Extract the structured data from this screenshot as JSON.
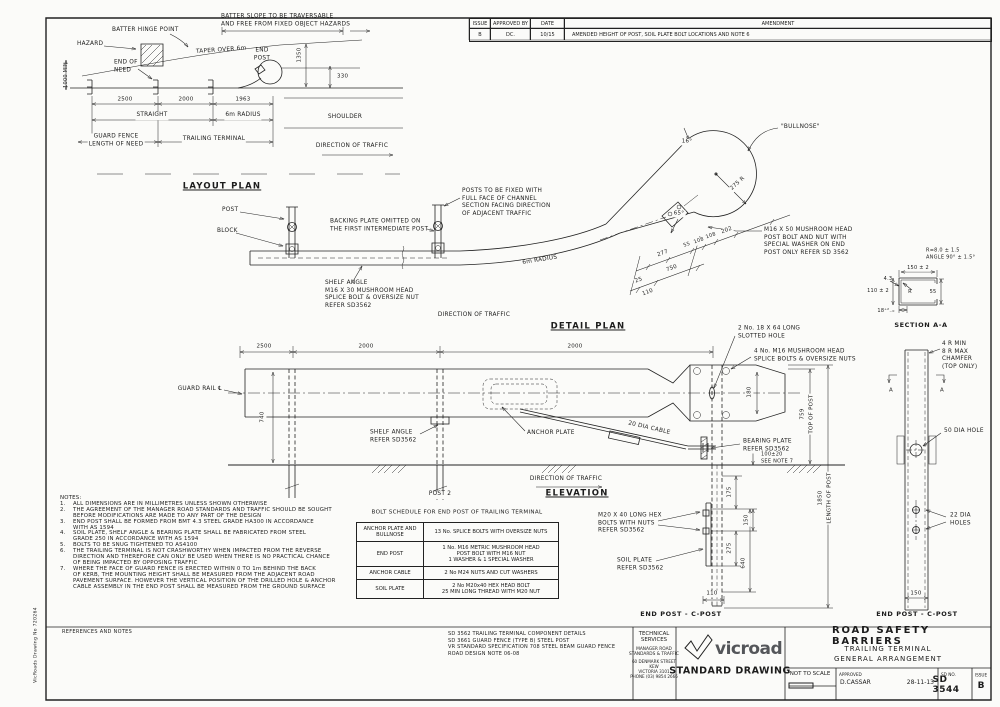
{
  "side_label": "VicRoads Drawing No 720264",
  "issue_table": {
    "headers": [
      "ISSUE",
      "APPROVED BY",
      "DATE",
      "AMENDMENT"
    ],
    "rows": [
      {
        "issue": "B",
        "approved_by": "DC.",
        "date": "10/15",
        "amendment": "AMENDED HEIGHT OF POST, SOIL PLATE BOLT LOCATIONS AND NOTE 6"
      }
    ]
  },
  "layout_plan": {
    "annotations": [
      {
        "t": "BATTER SLOPE TO BE TRAVERSABLE\nAND FREE FROM FIXED OBJECT HAZARDS",
        "x": 221,
        "y": 21,
        "a": "l"
      },
      {
        "t": "BATTER HINGE POINT",
        "x": 112,
        "y": 31,
        "a": "l"
      },
      {
        "t": "HAZARD",
        "x": 77,
        "y": 45,
        "a": "l"
      },
      {
        "t": "TAPER OVER 6m",
        "x": 196,
        "y": 51,
        "a": "l",
        "r": -4
      },
      {
        "t": "END\nPOST",
        "x": 262,
        "y": 55
      },
      {
        "t": "END OF\nNEED",
        "x": 114,
        "y": 67,
        "a": "l"
      },
      {
        "t": "1000 MIN",
        "x": 66,
        "y": 75,
        "r": -90,
        "fs": 5
      },
      {
        "t": "1350",
        "x": 300,
        "y": 55,
        "r": -90,
        "fs": 5.5,
        "cls": "wbg"
      },
      {
        "t": "330",
        "x": 337,
        "y": 77,
        "a": "l",
        "fs": 5.5
      },
      {
        "t": "2500",
        "x": 125,
        "y": 100,
        "fs": 5.5,
        "cls": "wbg"
      },
      {
        "t": "2000",
        "x": 186,
        "y": 100,
        "fs": 5.5,
        "cls": "wbg"
      },
      {
        "t": "1963",
        "x": 243,
        "y": 100,
        "fs": 5.5,
        "cls": "wbg"
      },
      {
        "t": "STRAIGHT",
        "x": 152,
        "y": 116,
        "cls": "wbg"
      },
      {
        "t": "6m RADIUS",
        "x": 243,
        "y": 116,
        "cls": "wbg"
      },
      {
        "t": "SHOULDER",
        "x": 345,
        "y": 118
      },
      {
        "t": "GUARD FENCE\nLENGTH OF NEED",
        "x": 116,
        "y": 141,
        "cls": "wbg"
      },
      {
        "t": "TRAILING TERMINAL",
        "x": 214,
        "y": 140,
        "cls": "wbg"
      },
      {
        "t": "DIRECTION OF TRAFFIC",
        "x": 352,
        "y": 147
      },
      {
        "t": "LAYOUT PLAN",
        "x": 222,
        "y": 187,
        "cls": "title"
      }
    ]
  },
  "detail_plan": {
    "annotations": [
      {
        "t": "POST",
        "x": 222,
        "y": 211,
        "a": "l"
      },
      {
        "t": "BLOCK",
        "x": 217,
        "y": 232,
        "a": "l"
      },
      {
        "t": "BACKING PLATE OMITTED ON\nTHE FIRST INTERMEDIATE POST",
        "x": 330,
        "y": 226,
        "a": "l"
      },
      {
        "t": "POSTS TO BE FIXED WITH\nFULL FACE OF CHANNEL\nSECTION FACING DIRECTION\nOF ADJACENT TRAFFIC",
        "x": 462,
        "y": 203,
        "a": "l"
      },
      {
        "t": "SHELF ANGLE\nM16 X 30 MUSHROOM HEAD\nSPLICE BOLT & OVERSIZE NUT\nREFER SD3562",
        "x": 325,
        "y": 295,
        "a": "l"
      },
      {
        "t": "6m RADIUS",
        "x": 540,
        "y": 261,
        "r": -9,
        "cls": "wbg"
      },
      {
        "t": "DIRECTION OF TRAFFIC",
        "x": 474,
        "y": 316
      },
      {
        "t": "DETAIL PLAN",
        "x": 588,
        "y": 327,
        "cls": "title"
      }
    ]
  },
  "bullnose": {
    "annotations": [
      {
        "t": "\"BULLNOSE\"",
        "x": 781,
        "y": 128,
        "a": "l"
      },
      {
        "t": "16°",
        "x": 687,
        "y": 142,
        "fs": 5.5,
        "cls": "wbg"
      },
      {
        "t": "65°",
        "x": 679,
        "y": 214,
        "fs": 5.5,
        "cls": "wbg"
      },
      {
        "t": "275 R",
        "x": 738,
        "y": 184,
        "r": -42,
        "fs": 5.5,
        "cls": "wbg"
      },
      {
        "t": "M16 X 50 MUSHROOM HEAD\nPOST BOLT AND NUT WITH\nSPECIAL WASHER ON END\nPOST ONLY REFER SD 3562",
        "x": 764,
        "y": 242,
        "a": "l"
      },
      {
        "t": "277",
        "x": 663,
        "y": 254,
        "r": -20,
        "fs": 5.5,
        "cls": "wbg"
      },
      {
        "t": "55",
        "x": 687,
        "y": 245,
        "r": -20,
        "fs": 5,
        "cls": "wbg"
      },
      {
        "t": "108",
        "x": 699,
        "y": 241,
        "r": -20,
        "fs": 5,
        "cls": "wbg"
      },
      {
        "t": "108",
        "x": 711,
        "y": 236,
        "r": -20,
        "fs": 5,
        "cls": "wbg"
      },
      {
        "t": "202",
        "x": 727,
        "y": 231,
        "r": -20,
        "fs": 5.5,
        "cls": "wbg"
      },
      {
        "t": "25",
        "x": 639,
        "y": 281,
        "r": -20,
        "fs": 5.5,
        "cls": "wbg"
      },
      {
        "t": "750",
        "x": 672,
        "y": 269,
        "r": -20,
        "fs": 5.5,
        "cls": "wbg"
      },
      {
        "t": "110",
        "x": 648,
        "y": 293,
        "r": -20,
        "fs": 5.5,
        "cls": "wbg"
      }
    ]
  },
  "section_aa": {
    "annotations": [
      {
        "t": "R=8.0 ± 1.5\nANGLE 90° ± 1.5°",
        "x": 926,
        "y": 254,
        "a": "l",
        "fs": 5
      },
      {
        "t": "150 ± 2",
        "x": 918,
        "y": 268,
        "fs": 5,
        "cls": "wbg"
      },
      {
        "t": "4.3",
        "x": 888,
        "y": 279,
        "fs": 5
      },
      {
        "t": "110 ± 2",
        "x": 878,
        "y": 291,
        "fs": 5,
        "cls": "wbg"
      },
      {
        "t": "R",
        "x": 910,
        "y": 292,
        "fs": 5
      },
      {
        "t": "55",
        "x": 933,
        "y": 292,
        "fs": 5,
        "cls": "wbg"
      },
      {
        "t": "18⁺²₋₀",
        "x": 886,
        "y": 311,
        "fs": 5,
        "cls": "wbg"
      },
      {
        "t": "SECTION A-A",
        "x": 921,
        "y": 325,
        "cls": "sub"
      }
    ]
  },
  "elevation": {
    "annotations": [
      {
        "t": "2500",
        "x": 264,
        "y": 347,
        "fs": 5.5,
        "cls": "wbg"
      },
      {
        "t": "2000",
        "x": 366,
        "y": 347,
        "fs": 5.5,
        "cls": "wbg"
      },
      {
        "t": "2000",
        "x": 575,
        "y": 347,
        "fs": 5.5,
        "cls": "wbg"
      },
      {
        "t": "GUARD RAIL ℄",
        "x": 222,
        "y": 390,
        "a": "r"
      },
      {
        "t": "740",
        "x": 263,
        "y": 417,
        "r": -90,
        "fs": 5.5,
        "cls": "wbg"
      },
      {
        "t": "SHELF ANGLE\nREFER SD3562",
        "x": 370,
        "y": 437,
        "a": "l"
      },
      {
        "t": "ANCHOR PLATE",
        "x": 527,
        "y": 434,
        "a": "l"
      },
      {
        "t": "20 DIA CABLE",
        "x": 649,
        "y": 429,
        "r": 13,
        "cls": "wbg"
      },
      {
        "t": "2 No. 18 X 64 LONG\nSLOTTED HOLE",
        "x": 737,
        "y": 333,
        "a": "l",
        "cls": "wbg"
      },
      {
        "t": "4 No. M16 MUSHROOM HEAD\nSPLICE BOLTS & OVERSIZE NUTS",
        "x": 753,
        "y": 356,
        "a": "l",
        "cls": "wbg"
      },
      {
        "t": "180",
        "x": 750,
        "y": 392,
        "r": -90,
        "fs": 5.5,
        "cls": "wbg"
      },
      {
        "t": "759",
        "x": 803,
        "y": 414,
        "r": -90,
        "fs": 5.5,
        "cls": "wbg"
      },
      {
        "t": "TOP OF POST",
        "x": 812,
        "y": 414,
        "r": -90,
        "fs": 5.5,
        "cls": "wbg"
      },
      {
        "t": "BEARING PLATE\nREFER SD3562",
        "x": 742,
        "y": 446,
        "a": "l",
        "cls": "wbg"
      },
      {
        "t": "100±20\nSEE NOTE 7",
        "x": 760,
        "y": 458,
        "a": "l",
        "fs": 5,
        "cls": "wbg"
      },
      {
        "t": "DIRECTION OF TRAFFIC",
        "x": 566,
        "y": 480
      },
      {
        "t": "POST 2",
        "x": 440,
        "y": 495,
        "cls": "wbg"
      },
      {
        "t": "ELEVATION",
        "x": 577,
        "y": 494,
        "cls": "title"
      },
      {
        "t": "M20 X 40 LONG HEX\nBOLTS WITH NUTS\nREFER SD3562",
        "x": 598,
        "y": 524,
        "a": "l"
      },
      {
        "t": "SOIL PLATE\nREFER SD3562",
        "x": 617,
        "y": 565,
        "a": "l"
      },
      {
        "t": "175",
        "x": 730,
        "y": 492,
        "r": -90,
        "fs": 5.5,
        "cls": "wbg"
      },
      {
        "t": "150",
        "x": 747,
        "y": 520,
        "r": -90,
        "fs": 5.5,
        "cls": "wbg"
      },
      {
        "t": "275",
        "x": 730,
        "y": 548,
        "r": -90,
        "fs": 5.5,
        "cls": "wbg"
      },
      {
        "t": "640",
        "x": 744,
        "y": 563,
        "r": -90,
        "fs": 5.5,
        "cls": "wbg"
      },
      {
        "t": "110",
        "x": 712,
        "y": 594,
        "fs": 5.5,
        "cls": "wbg"
      },
      {
        "t": "1850",
        "x": 821,
        "y": 498,
        "r": -90,
        "fs": 5.5,
        "cls": "wbg"
      },
      {
        "t": "LENGTH OF POST",
        "x": 830,
        "y": 498,
        "r": -90,
        "fs": 5.5,
        "cls": "wbg"
      },
      {
        "t": "END POST - C-POST",
        "x": 681,
        "y": 614,
        "cls": "sub"
      }
    ]
  },
  "end_post_right": {
    "annotations": [
      {
        "t": "4 R MIN\n8 R MAX\nCHAMFER\n(TOP ONLY)",
        "x": 942,
        "y": 356,
        "a": "l"
      },
      {
        "t": "A",
        "x": 891,
        "y": 391,
        "fs": 5.5
      },
      {
        "t": "A",
        "x": 942,
        "y": 391,
        "fs": 5.5
      },
      {
        "t": "50 DIA HOLE",
        "x": 944,
        "y": 432,
        "a": "l"
      },
      {
        "t": "22 DIA\nHOLES",
        "x": 950,
        "y": 520,
        "a": "l"
      },
      {
        "t": "150",
        "x": 916,
        "y": 594,
        "fs": 5.5,
        "cls": "wbg"
      },
      {
        "t": "END POST - C-POST",
        "x": 917,
        "y": 614,
        "cls": "sub"
      }
    ]
  },
  "notes": {
    "heading": "NOTES:",
    "items": [
      {
        "num": "1.",
        "text": "ALL DIMENSIONS ARE IN MILLIMETRES UNLESS SHOWN OTHERWISE"
      },
      {
        "num": "2.",
        "text": "THE AGREEMENT OF THE MANAGER ROAD STANDARDS AND TRAFFIC SHOULD BE SOUGHT\nBEFORE MODIFICATIONS ARE MADE TO ANY PART OF THE DESIGN"
      },
      {
        "num": "3.",
        "text": "END POST SHALL BE FORMED FROM BMT 4.3 STEEL GRADE HA300 IN ACCORDANCE\nWITH AS 1594"
      },
      {
        "num": "4.",
        "text": "SOIL PLATE, SHELF ANGLE & BEARING PLATE SHALL BE FABRICATED FROM STEEL\nGRADE 250 IN ACCORDANCE WITH AS 1594"
      },
      {
        "num": "5.",
        "text": "BOLTS TO BE SNUG TIGHTENED TO AS4100"
      },
      {
        "num": "6.",
        "text": "THE TRAILING TERMINAL IS NOT CRASHWORTHY WHEN IMPACTED FROM THE REVERSE\nDIRECTION AND THEREFORE CAN ONLY BE USED WHEN THERE IS NO PRACTICAL CHANCE\nOF BEING IMPACTED BY OPPOSING TRAFFIC"
      },
      {
        "num": "7.",
        "text": "WHERE THE FACE OF GUARD FENCE IS ERECTED WITHIN 0 TO 1m BEHIND THE BACK\nOF KERB, THE MOUNTING HEIGHT SHALL BE MEASURED FROM THE ADJACENT ROAD\nPAVEMENT SURFACE. HOWEVER THE VERTICAL POSITION OF THE DRILLED HOLE & ANCHOR\nCABLE ASSEMBLY IN THE END POST SHALL BE MEASURED FROM THE GROUND SURFACE"
      }
    ]
  },
  "bolt_schedule": {
    "title": "BOLT SCHEDULE FOR END POST OF TRAILING TERMINAL",
    "rows": [
      [
        "ANCHOR PLATE AND\nBULLNOSE",
        "13 No. SPLICE BOLTS WITH OVERSIZE NUTS"
      ],
      [
        "END POST",
        "1 No. M16 METRIC MUSHROOM HEAD\nPOST BOLT WITH M16 NUT\n1 WASHER & 1 SPECIAL WASHER"
      ],
      [
        "ANCHOR CABLE",
        "2 No M24 NUTS AND CUT WASHERS"
      ],
      [
        "SOIL PLATE",
        "2 No M20x40 HEX HEAD BOLT\n25 MIN LONG THREAD WITH M20 NUT"
      ]
    ]
  },
  "references": {
    "label": "REFERENCES AND NOTES",
    "text": "SD 3562 TRAILING TERMINAL COMPONENT DETAILS\nSD 3661 GUARD FENCE (TYPE B) STEEL POST\nVR STANDARD SPECIFICATION 708 STEEL BEAM GUARD FENCE\nROAD DESIGN NOTE 06-08"
  },
  "org_block": {
    "name": "TECHNICAL\nSERVICES",
    "dept": "MANAGER ROAD\nSTANDARDS & TRAFFIC",
    "address": "60 DENMARK STREET\nKEW\nVICTORIA 3101\nPHONE (03) 9854 2666"
  },
  "logo": {
    "brand": "vicroads",
    "subtitle": "STANDARD DRAWING",
    "green_dark": "#00693e",
    "green_light": "#78be20",
    "text_color": "#54565a"
  },
  "title_block": {
    "title": "ROAD SAFETY BARRIERS",
    "subtitle1": "TRAILING TERMINAL",
    "subtitle2": "GENERAL ARRANGEMENT",
    "scale_label": "NOT TO SCALE",
    "approved_label": "APPROVED",
    "approved_by": "D.CASSAR",
    "approved_date": "28-11-13",
    "sd_no_label": "SD NO.",
    "sd_no": "SD 3544",
    "issue_label": "ISSUE",
    "issue": "B"
  }
}
